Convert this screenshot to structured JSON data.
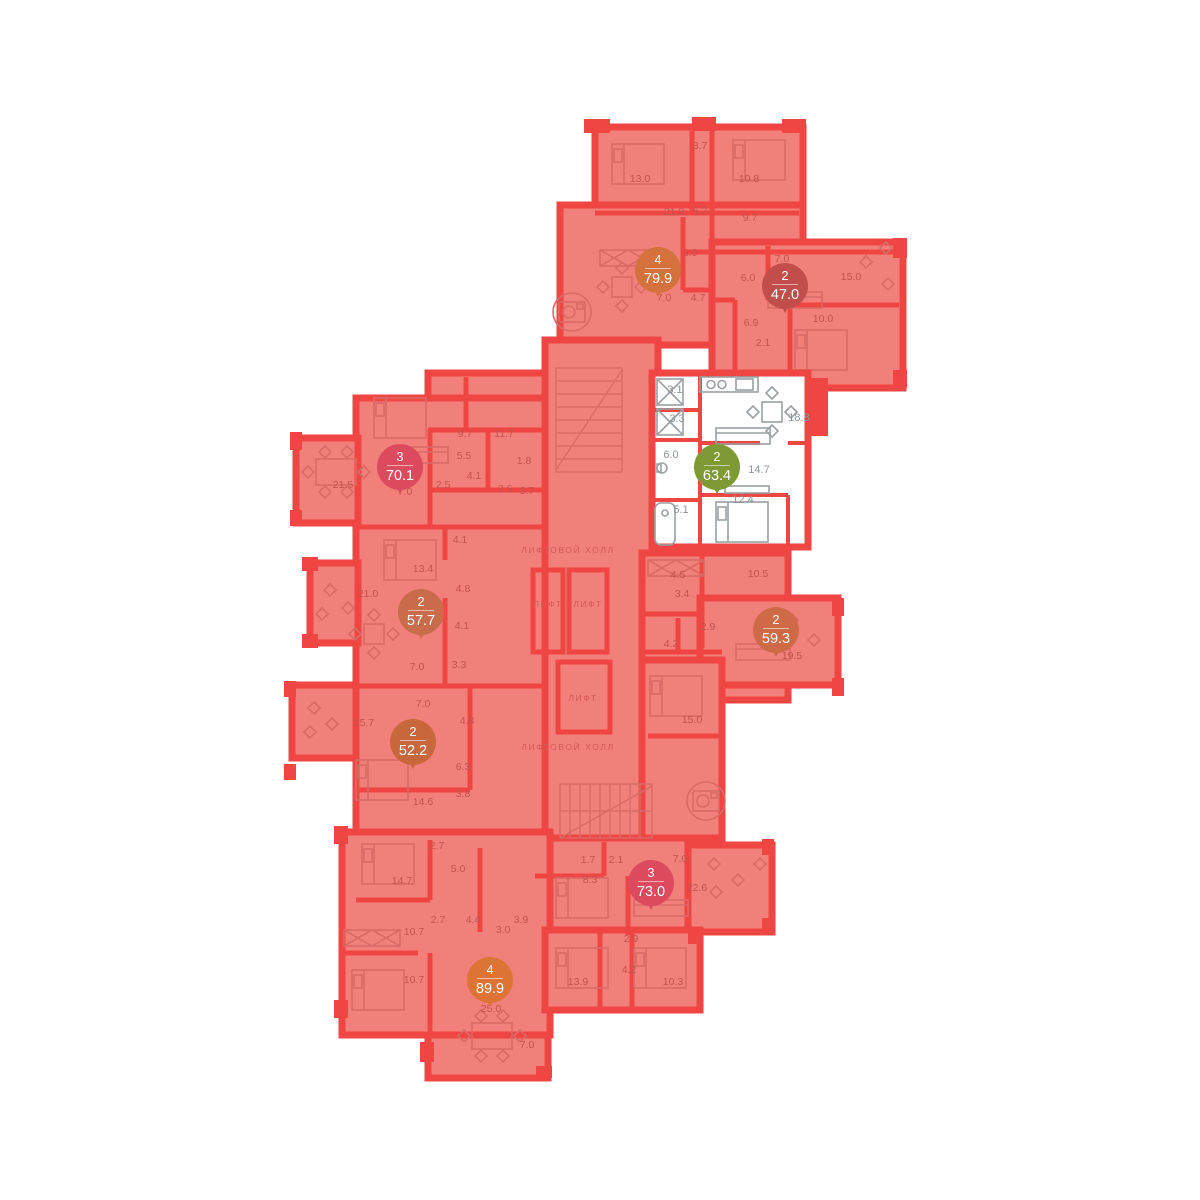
{
  "plan": {
    "type": "residential-floor-plan",
    "colors": {
      "floor": "#f1807b",
      "wall": "#ef4643",
      "selected_floor": "#ffffff",
      "label_red": "#c5514e",
      "label_gray": "#8f9498",
      "lift_text": "#d25955",
      "badge_selected_green": "#7e9a34",
      "badge_orange": "#dd7435",
      "badge_crimson": "#dc4a5e"
    },
    "apartments": [
      {
        "rooms": "4",
        "area": "79.9",
        "x": 658,
        "y": 270,
        "color": "#d4713c",
        "selected": false
      },
      {
        "rooms": "2",
        "area": "47.0",
        "x": 785,
        "y": 286,
        "color": "#c24e4c",
        "selected": false
      },
      {
        "rooms": "3",
        "area": "70.1",
        "x": 400,
        "y": 467,
        "color": "#dc4a5e",
        "selected": false
      },
      {
        "rooms": "2",
        "area": "63.4",
        "x": 717,
        "y": 467,
        "color": "#7e9a34",
        "selected": true
      },
      {
        "rooms": "2",
        "area": "57.7",
        "x": 421,
        "y": 612,
        "color": "#c96c4b",
        "selected": false
      },
      {
        "rooms": "2",
        "area": "59.3",
        "x": 776,
        "y": 630,
        "color": "#cf6a47",
        "selected": false
      },
      {
        "rooms": "2",
        "area": "52.2",
        "x": 413,
        "y": 742,
        "color": "#c8663c",
        "selected": false
      },
      {
        "rooms": "3",
        "area": "73.0",
        "x": 651,
        "y": 883,
        "color": "#dc4a5e",
        "selected": false
      },
      {
        "rooms": "4",
        "area": "89.9",
        "x": 490,
        "y": 980,
        "color": "#dd7435",
        "selected": false
      }
    ],
    "room_area_labels": [
      {
        "text": "13.0",
        "x": 640,
        "y": 182
      },
      {
        "text": "3.7",
        "x": 700,
        "y": 149
      },
      {
        "text": "10.8",
        "x": 749,
        "y": 182
      },
      {
        "text": "21.8",
        "x": 674,
        "y": 215
      },
      {
        "text": "6.2",
        "x": 700,
        "y": 214
      },
      {
        "text": "9.7",
        "x": 750,
        "y": 221
      },
      {
        "text": "3.0",
        "x": 690,
        "y": 256
      },
      {
        "text": "7.0",
        "x": 664,
        "y": 301
      },
      {
        "text": "4.7",
        "x": 698,
        "y": 301
      },
      {
        "text": "7.0",
        "x": 782,
        "y": 262
      },
      {
        "text": "6.0",
        "x": 748,
        "y": 281
      },
      {
        "text": "15.0",
        "x": 851,
        "y": 280
      },
      {
        "text": "10.0",
        "x": 823,
        "y": 322
      },
      {
        "text": "6.9",
        "x": 751,
        "y": 326
      },
      {
        "text": "2.1",
        "x": 763,
        "y": 346
      },
      {
        "text": "9.7",
        "x": 465,
        "y": 437
      },
      {
        "text": "11.7",
        "x": 504,
        "y": 437
      },
      {
        "text": "5.5",
        "x": 464,
        "y": 459
      },
      {
        "text": "1.8",
        "x": 524,
        "y": 464
      },
      {
        "text": "21.5",
        "x": 343,
        "y": 488
      },
      {
        "text": "7.0",
        "x": 405,
        "y": 495
      },
      {
        "text": "2.5",
        "x": 443,
        "y": 488
      },
      {
        "text": "4.1",
        "x": 474,
        "y": 479
      },
      {
        "text": "2.6",
        "x": 505,
        "y": 492
      },
      {
        "text": "3.7",
        "x": 527,
        "y": 494
      },
      {
        "text": "4.1",
        "x": 460,
        "y": 543
      },
      {
        "text": "13.4",
        "x": 423,
        "y": 572
      },
      {
        "text": "21.0",
        "x": 368,
        "y": 597
      },
      {
        "text": "4.8",
        "x": 463,
        "y": 592
      },
      {
        "text": "4.1",
        "x": 462,
        "y": 629
      },
      {
        "text": "7.0",
        "x": 417,
        "y": 670
      },
      {
        "text": "3.3",
        "x": 459,
        "y": 668
      },
      {
        "text": "7.0",
        "x": 423,
        "y": 707
      },
      {
        "text": "15.7",
        "x": 364,
        "y": 726
      },
      {
        "text": "4.8",
        "x": 467,
        "y": 724
      },
      {
        "text": "6.3",
        "x": 463,
        "y": 770
      },
      {
        "text": "14.6",
        "x": 423,
        "y": 805
      },
      {
        "text": "3.8",
        "x": 463,
        "y": 797
      },
      {
        "text": "2.7",
        "x": 437,
        "y": 849
      },
      {
        "text": "5.0",
        "x": 458,
        "y": 872
      },
      {
        "text": "14.7",
        "x": 402,
        "y": 884
      },
      {
        "text": "10.7",
        "x": 414,
        "y": 935
      },
      {
        "text": "2.7",
        "x": 438,
        "y": 923
      },
      {
        "text": "4.4",
        "x": 473,
        "y": 923
      },
      {
        "text": "3.0",
        "x": 503,
        "y": 933
      },
      {
        "text": "3.9",
        "x": 521,
        "y": 923
      },
      {
        "text": "10.7",
        "x": 414,
        "y": 983
      },
      {
        "text": "25.0",
        "x": 491,
        "y": 1012
      },
      {
        "text": "7.0",
        "x": 527,
        "y": 1048
      },
      {
        "text": "13.9",
        "x": 578,
        "y": 985
      },
      {
        "text": "10.3",
        "x": 673,
        "y": 985
      },
      {
        "text": "1.7",
        "x": 588,
        "y": 863
      },
      {
        "text": "2.1",
        "x": 616,
        "y": 863
      },
      {
        "text": "7.0",
        "x": 680,
        "y": 862
      },
      {
        "text": "8.3",
        "x": 590,
        "y": 883
      },
      {
        "text": "22.6",
        "x": 697,
        "y": 891
      },
      {
        "text": "2.9",
        "x": 631,
        "y": 942
      },
      {
        "text": "4.2",
        "x": 629,
        "y": 973
      },
      {
        "text": "4.5",
        "x": 678,
        "y": 578
      },
      {
        "text": "10.5",
        "x": 758,
        "y": 577
      },
      {
        "text": "3.4",
        "x": 682,
        "y": 597
      },
      {
        "text": "2.9",
        "x": 708,
        "y": 630
      },
      {
        "text": "4.2",
        "x": 671,
        "y": 647
      },
      {
        "text": "19.5",
        "x": 792,
        "y": 659
      },
      {
        "text": "15.0",
        "x": 692,
        "y": 723
      }
    ],
    "selected_apartment_labels": [
      {
        "text": "3.1",
        "x": 675,
        "y": 393
      },
      {
        "text": "3.3",
        "x": 677,
        "y": 422
      },
      {
        "text": "18.8",
        "x": 799,
        "y": 421
      },
      {
        "text": "6.0",
        "x": 671,
        "y": 458
      },
      {
        "text": "14.7",
        "x": 759,
        "y": 473
      },
      {
        "text": "5.1",
        "x": 681,
        "y": 513
      },
      {
        "text": "12.4",
        "x": 743,
        "y": 503
      }
    ],
    "lift_labels": [
      {
        "text": "ЛИФТОВОЙ ХОЛЛ",
        "x": 568,
        "y": 553
      },
      {
        "text": "ЛИФТ",
        "x": 548,
        "y": 607
      },
      {
        "text": "ЛИФТ",
        "x": 588,
        "y": 607
      },
      {
        "text": "ЛИФТ",
        "x": 583,
        "y": 701
      },
      {
        "text": "ЛИФТОВОЙ ХОЛЛ",
        "x": 568,
        "y": 750
      }
    ]
  }
}
